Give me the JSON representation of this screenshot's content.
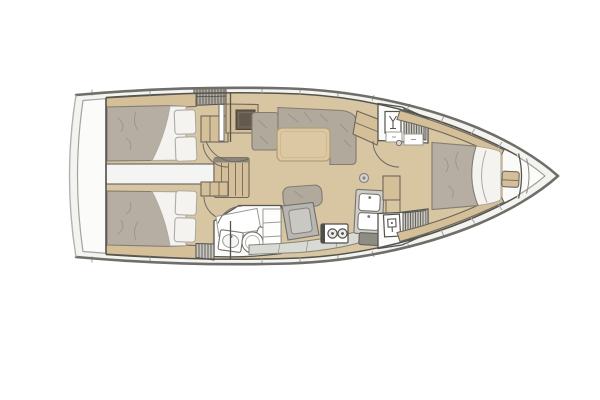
{
  "title": "Sailing yacht interior layout floor plan, bow to the right",
  "palette": {
    "hull_line": "#6f6e6a",
    "inner_line": "#a3a29e",
    "deck": "#f3f3f0",
    "room": "#fbfbf9",
    "wall": "#55544f",
    "wall_soft": "#6d675c",
    "door": "#6b6a66",
    "floor": "#d8c5a1",
    "wood": "#d4bf98",
    "table": "#dcc8a3",
    "table_edge": "#b49e74",
    "mattress": "#b7aea3",
    "cushion": "#b2a99d",
    "mat_edge": "#837c70",
    "mat_line": "#938b80",
    "linen": "#f4f3f0",
    "linen_line": "#adaba4",
    "grate": "#c9c6c0",
    "grate_line": "#4d4b47",
    "counter": "#dadad5",
    "counter_line": "#9c9a93",
    "fixture": "#76746e",
    "dark_inset": "#645b4e",
    "desk": "#b8b6b1",
    "desk_light": "#cac8c3",
    "hatch": "#b0aca2",
    "steel": "#8e8c85",
    "transom": "#b3b2ae"
  },
  "areas": {
    "hull": {
      "label": "Hull outline with side decks, bow right, transom left"
    },
    "aft_cabin_top": {
      "label": "Aft double cabin (upper) with berth, two pillows and wardrobe"
    },
    "aft_cabin_bottom": {
      "label": "Aft double cabin (lower) with berth, two pillows and wardrobe"
    },
    "engine": {
      "label": "Engine compartment between aft cabins"
    },
    "companionway": {
      "label": "Companionway steps and sliding hatch"
    },
    "salon": {
      "label": "Salon with L-settee, table, stool and sideboard"
    },
    "nav": {
      "label": "Navigation station with chart desk and seat"
    },
    "aft_head": {
      "label": "Aft head with toilet, washbasin and shower grate"
    },
    "galley": {
      "label": "Galley with two-burner stove, double sink and icebox"
    },
    "fwd_head": {
      "label": "Forward head compartment with toilet"
    },
    "fwd_shower": {
      "label": "Forward shower compartment"
    },
    "fwd_cabin": {
      "label": "Forward owner cabin with island double berth and bench"
    },
    "bow": {
      "label": "Bow anchor locker"
    }
  }
}
